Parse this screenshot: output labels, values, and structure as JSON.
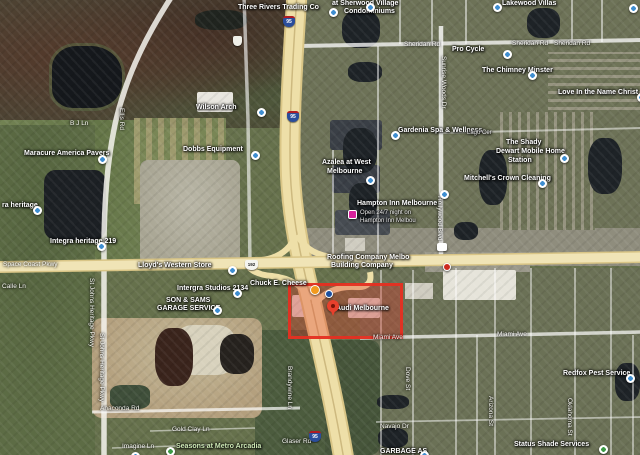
{
  "map": {
    "description": "Satellite map view of West Melbourne FL area around I-95 and US-192 with Audi Melbourne highlighted by a red rectangle",
    "highlight": {
      "label": "Audi Melbourne",
      "color": "#e4301f",
      "x": 288,
      "y": 283,
      "w": 115,
      "h": 56
    },
    "colors": {
      "freeway": "#eedfa8",
      "freeway_casing": "#d9c586",
      "major_road": "#f0e4b6",
      "minor_road": "#ffffff",
      "water": "#1e2327",
      "poi_pin": "#3f8ed0",
      "park_pin": "#3d9a46",
      "highlight_red": "#e4301f",
      "ad_pin": "#d6219c",
      "orange_pin": "#f29a1e"
    },
    "road_labels": [
      {
        "text": "Sheridan Rd",
        "x": 404,
        "y": 41
      },
      {
        "text": "Sheridan Rd",
        "x": 512,
        "y": 40
      },
      {
        "text": "Sheridan Rd",
        "x": 554,
        "y": 40
      },
      {
        "text": "Space Coast Pkwy",
        "x": 3,
        "y": 261
      },
      {
        "text": "Miami Ave",
        "x": 373,
        "y": 334
      },
      {
        "text": "Miami Ave",
        "x": 497,
        "y": 331
      },
      {
        "text": "Anaconda Rd",
        "x": 100,
        "y": 405
      },
      {
        "text": "Navajo Dr",
        "x": 380,
        "y": 423
      },
      {
        "text": "Glaser Rd",
        "x": 282,
        "y": 438
      },
      {
        "text": "Gold Clay Ln",
        "x": 172,
        "y": 426
      },
      {
        "text": "Imagine Ln",
        "x": 122,
        "y": 443
      },
      {
        "text": "B J Ln",
        "x": 70,
        "y": 120
      },
      {
        "text": "Calle Ln",
        "x": 2,
        "y": 283
      },
      {
        "text": "Hollywood Blvd",
        "x": 436,
        "y": 196,
        "vertical": true
      },
      {
        "text": "St Johns Heritage Pkwy",
        "x": 88,
        "y": 278,
        "vertical": true
      },
      {
        "text": "St Johns Heritage Pkwy",
        "x": 98,
        "y": 333,
        "vertical": true
      },
      {
        "text": "Brandywine Ln",
        "x": 286,
        "y": 366,
        "vertical": true
      },
      {
        "text": "Arizona St",
        "x": 487,
        "y": 396,
        "vertical": true
      },
      {
        "text": "Oklahoma St",
        "x": 566,
        "y": 398,
        "vertical": true
      },
      {
        "text": "Dove St",
        "x": 404,
        "y": 367,
        "vertical": true
      },
      {
        "text": "Ellis Rd",
        "x": 118,
        "y": 108,
        "vertical": true
      },
      {
        "text": "Sunrise Woods Dr",
        "x": 440,
        "y": 56,
        "vertical": true
      }
    ],
    "place_labels": [
      {
        "text": "Three Rivers Trading Co",
        "x": 238,
        "y": 4
      },
      {
        "text": "at Sherwood Village",
        "x": 332,
        "y": 0
      },
      {
        "text": "Condominiums",
        "x": 344,
        "y": 8
      },
      {
        "text": "Lakewood Villas",
        "x": 502,
        "y": 0
      },
      {
        "text": "Pro Cycle",
        "x": 452,
        "y": 46
      },
      {
        "text": "The Chimney Minster",
        "x": 482,
        "y": 67
      },
      {
        "text": "Love In the Name Christ",
        "x": 558,
        "y": 89
      },
      {
        "text": "Gardenia Spa & Wellness",
        "x": 398,
        "y": 127
      },
      {
        "text": "Azalea at West",
        "x": 322,
        "y": 159
      },
      {
        "text": "Melbourne",
        "x": 327,
        "y": 168
      },
      {
        "text": "Hampton Inn Melbourne",
        "x": 357,
        "y": 200
      },
      {
        "text": "Open 24/7 night on",
        "x": 360,
        "y": 210,
        "small": true
      },
      {
        "text": "Hampton Inn Melbou",
        "x": 360,
        "y": 218,
        "small": true
      },
      {
        "text": "Mitchell's Crown Cleaning",
        "x": 464,
        "y": 175
      },
      {
        "text": "The Shady",
        "x": 506,
        "y": 139
      },
      {
        "text": "Dewart Mobile Home",
        "x": 496,
        "y": 148
      },
      {
        "text": "Station",
        "x": 508,
        "y": 157
      },
      {
        "text": "Lago Cer",
        "x": 467,
        "y": 130,
        "small": true
      },
      {
        "text": "Wilson Arch",
        "x": 196,
        "y": 104
      },
      {
        "text": "Dobbs Equipment",
        "x": 183,
        "y": 146
      },
      {
        "text": "Maracure America Pavers",
        "x": 24,
        "y": 150
      },
      {
        "text": "ra heritage",
        "x": 2,
        "y": 202
      },
      {
        "text": "Integra heritage 219",
        "x": 50,
        "y": 238
      },
      {
        "text": "Intergra Studios 2134",
        "x": 177,
        "y": 285
      },
      {
        "text": "SON & SAMS",
        "x": 166,
        "y": 297
      },
      {
        "text": "GARAGE SERVICE",
        "x": 157,
        "y": 305
      },
      {
        "text": "Lloyd's Western Store",
        "x": 138,
        "y": 262
      },
      {
        "text": "Chuck E. Cheese",
        "x": 250,
        "y": 280
      },
      {
        "text": "Roofing Company Melbo",
        "x": 327,
        "y": 254
      },
      {
        "text": "Building Company",
        "x": 331,
        "y": 262
      },
      {
        "text": "Audi Melbourne",
        "x": 336,
        "y": 305
      },
      {
        "text": "Redfox Pest Service",
        "x": 563,
        "y": 370
      },
      {
        "text": "Status Shade Services",
        "x": 514,
        "y": 441
      },
      {
        "text": "GARBAGE AS",
        "x": 380,
        "y": 448
      },
      {
        "text": "Seasons at Metro Arcadia",
        "x": 176,
        "y": 443,
        "green": true
      }
    ],
    "pins": [
      {
        "kind": "poi",
        "name": "three-rivers-trading-pin",
        "x": 329,
        "y": 8
      },
      {
        "kind": "poi",
        "name": "sherwood-village-pin",
        "x": 366,
        "y": 3
      },
      {
        "kind": "poi",
        "name": "lakewood-villas-pin",
        "x": 493,
        "y": 3
      },
      {
        "kind": "poi",
        "name": "poi-pin",
        "x": 629,
        "y": 4
      },
      {
        "kind": "poi",
        "name": "pro-cycle-pin",
        "x": 503,
        "y": 50
      },
      {
        "kind": "poi",
        "name": "chimney-pin",
        "x": 528,
        "y": 71
      },
      {
        "kind": "poi",
        "name": "love-inc-pin",
        "x": 637,
        "y": 93
      },
      {
        "kind": "poi",
        "name": "gardenia-spa-pin",
        "x": 391,
        "y": 131
      },
      {
        "kind": "poi",
        "name": "azalea-pin",
        "x": 366,
        "y": 176
      },
      {
        "kind": "poi",
        "name": "mitchells-pin",
        "x": 538,
        "y": 179
      },
      {
        "kind": "poi",
        "name": "dewart-mobile-pin",
        "x": 560,
        "y": 154
      },
      {
        "kind": "poi",
        "name": "wilson-arch-pin",
        "x": 257,
        "y": 108
      },
      {
        "kind": "poi",
        "name": "dobbs-equipment-pin",
        "x": 251,
        "y": 151
      },
      {
        "kind": "poi",
        "name": "maracure-pavers-pin",
        "x": 98,
        "y": 155
      },
      {
        "kind": "poi",
        "name": "heritage-pin",
        "x": 33,
        "y": 206
      },
      {
        "kind": "poi",
        "name": "integra-heritage-pin",
        "x": 97,
        "y": 242
      },
      {
        "kind": "poi",
        "name": "intergra-studios-pin",
        "x": 233,
        "y": 289
      },
      {
        "kind": "poi",
        "name": "garage-service-pin",
        "x": 213,
        "y": 306
      },
      {
        "kind": "poi",
        "name": "lloyds-western-pin",
        "x": 228,
        "y": 266
      },
      {
        "kind": "poi",
        "name": "poi-pin",
        "x": 440,
        "y": 190
      },
      {
        "kind": "poi",
        "name": "redfox-pest-pin",
        "x": 626,
        "y": 374
      },
      {
        "kind": "poi",
        "name": "garbage-pin",
        "x": 420,
        "y": 451
      },
      {
        "kind": "poi",
        "name": "poi-pin",
        "x": 131,
        "y": 452
      },
      {
        "kind": "green",
        "name": "status-shade-pin",
        "x": 599,
        "y": 445
      },
      {
        "kind": "green",
        "name": "seasons-park-pin",
        "x": 166,
        "y": 447
      },
      {
        "kind": "orange",
        "name": "chuck-e-cheese-pin",
        "x": 310,
        "y": 285
      },
      {
        "kind": "ad",
        "name": "hampton-inn-ad-pin",
        "x": 348,
        "y": 210
      },
      {
        "kind": "dotblue",
        "name": "business-logo-pin",
        "x": 325,
        "y": 290
      },
      {
        "kind": "dotred",
        "name": "business-logo-pin",
        "x": 443,
        "y": 263
      },
      {
        "kind": "badge",
        "name": "store-badge-pin",
        "x": 437,
        "y": 243
      },
      {
        "kind": "redpin",
        "name": "audi-melbourne-pin",
        "x": 327,
        "y": 300
      }
    ],
    "shields": [
      {
        "type": "i95",
        "text": "95",
        "x": 283,
        "y": 16
      },
      {
        "type": "i95",
        "text": "95",
        "x": 287,
        "y": 111
      },
      {
        "type": "i95",
        "text": "95",
        "x": 309,
        "y": 431
      },
      {
        "type": "us",
        "text": "192",
        "x": 245,
        "y": 260
      },
      {
        "type": "blank",
        "text": "",
        "x": 233,
        "y": 36
      }
    ]
  }
}
